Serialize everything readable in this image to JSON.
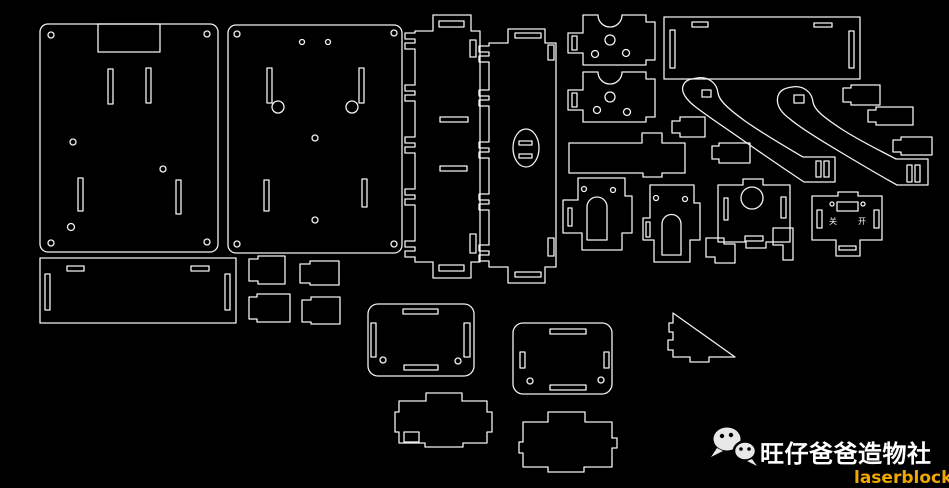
{
  "canvas": {
    "width": 949,
    "height": 488,
    "background": "#000000",
    "line_color": "#f2f2f2"
  },
  "branding": {
    "logo_icon": "wechat-icon",
    "studio_name": "旺仔爸爸造物社",
    "studio_name_color": "#ffffff",
    "brand_name": "laserblock",
    "brand_color": "#f0a800"
  },
  "engravings": {
    "switch_off": "关",
    "switch_on": "开"
  },
  "parts": [
    "base-panel-a",
    "base-panel-b",
    "side-strip-a",
    "side-strip-b",
    "motor-plate-a",
    "motor-plate-b",
    "top-cover",
    "crank-arm-a",
    "crank-arm-b",
    "key-tab-1",
    "key-tab-2",
    "key-tab-3",
    "small-tab",
    "cross-bar",
    "small-plate",
    "arch-bracket-a",
    "arch-bracket-b",
    "gear-plate",
    "step-tab-a",
    "step-tab-b",
    "switch-plate",
    "bottom-bar",
    "clip-1",
    "clip-2",
    "clip-3",
    "clip-4",
    "rounded-box-a",
    "rounded-box-b",
    "stepped-plate-a",
    "stepped-plate-b",
    "triangle-brace"
  ]
}
